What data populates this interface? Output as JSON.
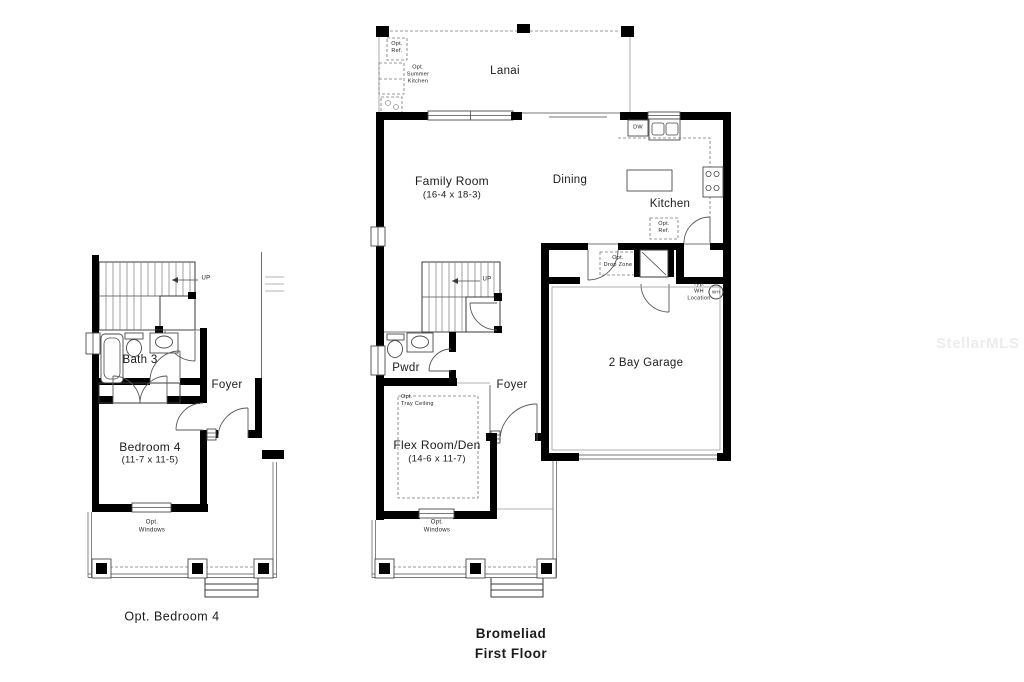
{
  "watermark": "StellarMLS",
  "colors": {
    "background": "#ffffff",
    "walls": "#000000",
    "text": "#1b1b1b",
    "watermark_gray": "#e8e8e8"
  },
  "left_plan": {
    "caption": "Opt. Bedroom 4",
    "labels": {
      "up": "UP",
      "bath": "Bath 3",
      "foyer": "Foyer",
      "bedroom": "Bedroom 4",
      "bedroom_dims": "(11-7 x 11-5)",
      "opt_windows": "Opt.\nWindows"
    }
  },
  "main_plan": {
    "title": "Bromeliad",
    "subtitle": "First Floor",
    "labels": {
      "lanai": "Lanai",
      "opt_ref_lanai": "Opt.\nRef.",
      "opt_summer_kitchen": "Opt.\nSummer\nKitchen",
      "family_room": "Family Room",
      "family_room_dims": "(16-4 x 18-3)",
      "dining": "Dining",
      "kitchen": "Kitchen",
      "dw": "DW",
      "opt_ref_kitchen": "Opt.\nRef.",
      "opt_drop_zone": "Opt.\nDrop Zone",
      "typ_wh_location": "Typ.\nWH\nLocation",
      "wh": "WH",
      "up": "UP",
      "two_bay_garage": "2 Bay Garage",
      "pwdr": "Pwdr",
      "foyer": "Foyer",
      "opt_tray_ceiling": "Opt.\nTray Ceiling",
      "flex_room": "Flex Room/Den",
      "flex_room_dims": "(14-6 x 11-7)",
      "opt_windows": "Opt.\nWindows"
    }
  }
}
